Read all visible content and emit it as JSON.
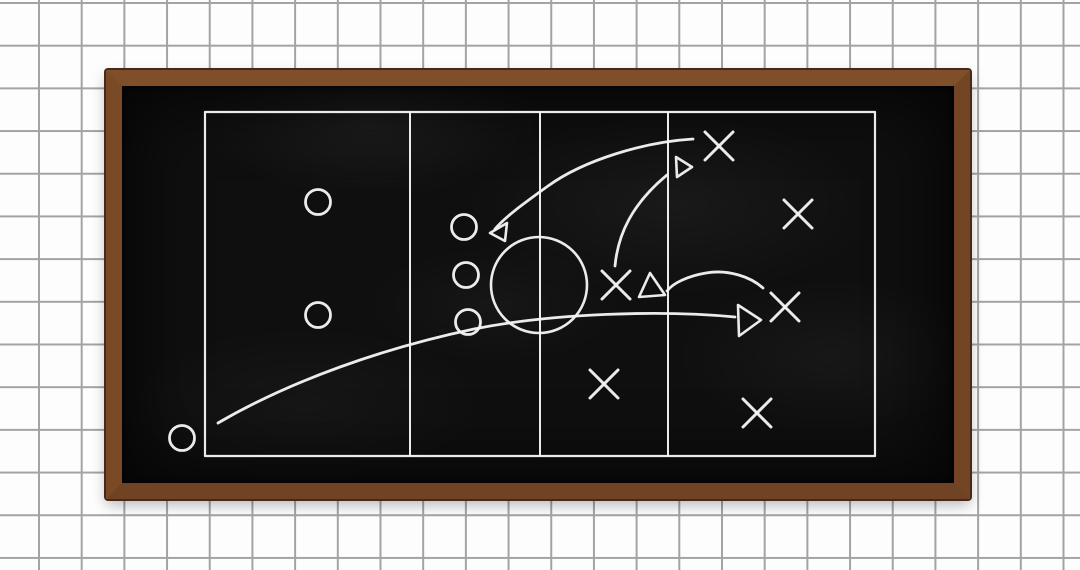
{
  "scene": {
    "description": "Wooden-framed blackboard on a squared grid wall showing a chalk game-strategy diagram with X and O players, a playing field and movement arrows",
    "wall": {
      "background_color": "#fdfdfd",
      "grid_line_color": "#a3a3a3",
      "grid_cell_size_px": 42.7
    },
    "board": {
      "x": 106,
      "y": 70,
      "width": 864,
      "height": 429,
      "frame_thickness": 16,
      "frame_color": "#7a4a27",
      "frame_edge_color": "#46291a",
      "surface_color": "#0f0f0f",
      "chalk_color": "#f5f5f5"
    }
  },
  "tactics": {
    "viewbox": "0 0 832 397",
    "strokes": {
      "field": 2.2,
      "divider": 2.0,
      "circle": 2.6,
      "o": 2.8,
      "x": 3.0,
      "arrow": 2.8,
      "head": 2.6
    },
    "field": {
      "x": 83,
      "y": 26,
      "width": 670,
      "height": 344,
      "dividers_x": [
        288,
        418,
        546
      ]
    },
    "center_circle": {
      "cx": 417,
      "cy": 199,
      "r": 48
    },
    "o_radius": 12.5,
    "o_markers": [
      {
        "cx": 196,
        "cy": 116
      },
      {
        "cx": 196,
        "cy": 229
      },
      {
        "cx": 342,
        "cy": 141
      },
      {
        "cx": 344,
        "cy": 189
      },
      {
        "cx": 346,
        "cy": 236
      },
      {
        "cx": 60,
        "cy": 352
      }
    ],
    "x_half_size": 14,
    "x_markers": [
      {
        "cx": 597,
        "cy": 60
      },
      {
        "cx": 676,
        "cy": 128
      },
      {
        "cx": 494,
        "cy": 199
      },
      {
        "cx": 663,
        "cy": 221
      },
      {
        "cx": 482,
        "cy": 298
      },
      {
        "cx": 635,
        "cy": 327
      }
    ],
    "arrows": [
      {
        "name": "arc-top-x-to-o-line",
        "path": "M 571 53 C 522 56 462 74 426 100 C 404 116 384 130 373 143",
        "head": "368 147 385 137 383 155"
      },
      {
        "name": "arc-center-x-upfield",
        "path": "M 493 180 C 496 148 510 118 545 89",
        "head": "554 71 570 81 555 91"
      },
      {
        "name": "arc-right-x-to-center-x",
        "path": "M 641 202 C 629 191 606 183 584 187 C 566 190 551 197 545 205",
        "head": "528 187 517 211 543 209"
      },
      {
        "name": "long-sweep-bottom-left-to-right",
        "path": "M 96 337 C 170 294 262 262 352 243 C 432 227 540 224 613 231",
        "head": "616 219 639 234 617 250"
      }
    ]
  }
}
